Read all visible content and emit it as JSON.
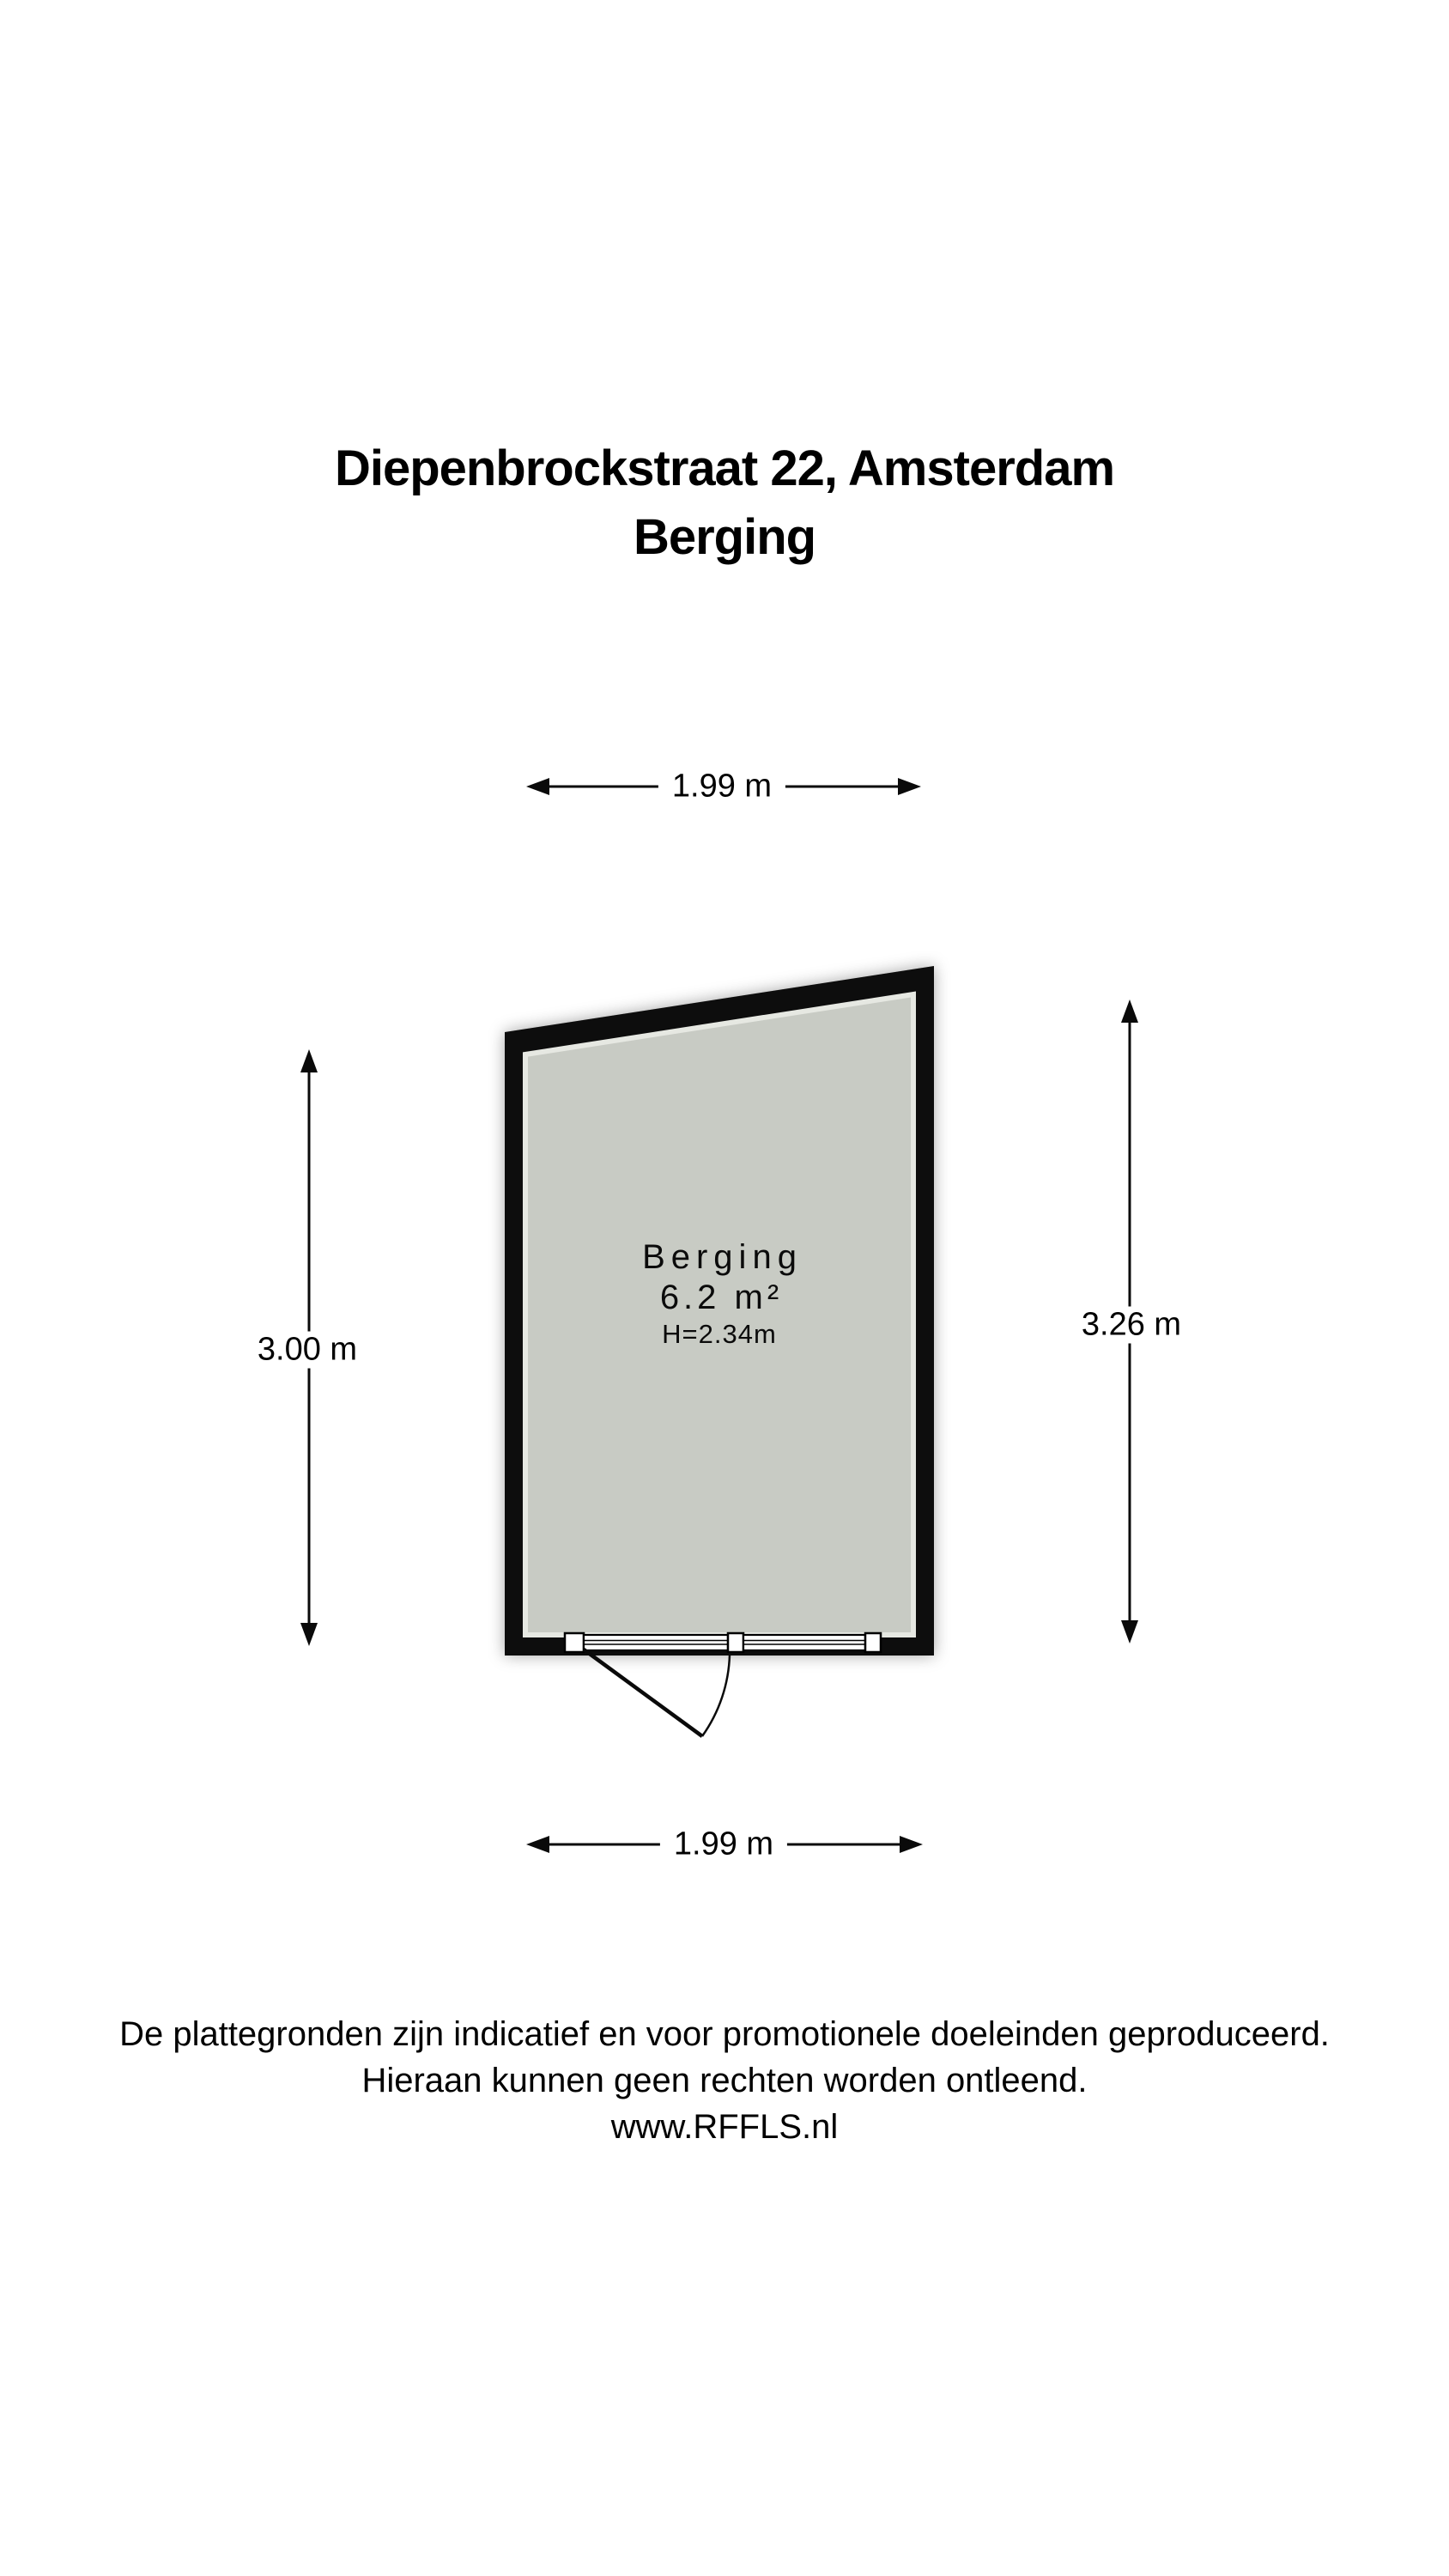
{
  "title": {
    "line1": "Diepenbrockstraat 22, Amsterdam",
    "line2": "Berging"
  },
  "room": {
    "name": "Berging",
    "area": "6.2 m²",
    "ceiling_height": "H=2.34m"
  },
  "dimensions": {
    "top": "1.99 m",
    "bottom": "1.99 m",
    "left": "3.00 m",
    "right": "3.26 m"
  },
  "footer": {
    "line1": "De plattegronden zijn indicatief en voor promotionele doeleinden geproduceerd.",
    "line2": "Hieraan kunnen geen rechten worden ontleend.",
    "line3": "www.RFFLS.nl"
  },
  "colors": {
    "wall": "#0a0a0a",
    "room_fill": "#c8cbc4",
    "room_inner_rim": "#e6e8e2",
    "text": "#000000",
    "background": "#ffffff"
  }
}
